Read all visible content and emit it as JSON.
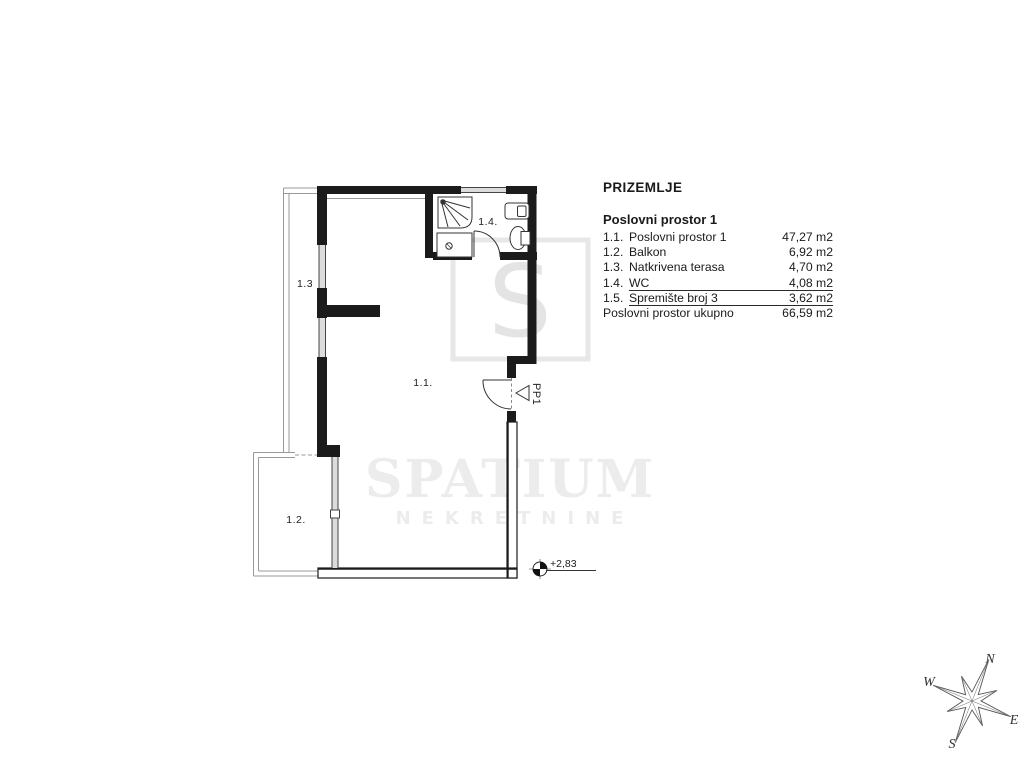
{
  "legend": {
    "heading": "PRIZEMLJE",
    "subheading": "Poslovni prostor 1",
    "rows": [
      {
        "num": "1.1.",
        "name": "Poslovni prostor 1",
        "area": "47,27 m2"
      },
      {
        "num": "1.2.",
        "name": "Balkon",
        "area": "6,92 m2"
      },
      {
        "num": "1.3.",
        "name": "Natkrivena terasa",
        "area": "4,70 m2"
      },
      {
        "num": "1.4.",
        "name": "WC",
        "area": "4,08 m2"
      },
      {
        "num": "1.5.",
        "name": "Spremište broj 3",
        "area": "3,62 m2"
      }
    ],
    "total": {
      "name": "Poslovni prostor ukupno",
      "area": "66,59 m2"
    }
  },
  "plan": {
    "room_labels": [
      {
        "id": "room-1-1",
        "text": "1.1."
      },
      {
        "id": "room-1-2",
        "text": "1.2."
      },
      {
        "id": "room-1-3",
        "text": "1.3"
      },
      {
        "id": "room-1-4",
        "text": "1.4."
      }
    ],
    "door_label": "PP1",
    "elevation_label": "+2,83"
  },
  "watermark": {
    "logo_letter": "S",
    "brand": "SPATIUM",
    "brand_sub": "NEKRETNINE"
  },
  "compass": {
    "n": "N",
    "e": "E",
    "s": "S",
    "w": "W"
  },
  "colors": {
    "line": "#1b1b1b",
    "thin_line": "#555555",
    "outline_gray": "#8a8a8a",
    "window_fill": "#dcdcdc",
    "watermark_gray": "#e9e9e9",
    "text": "#1a1a1a"
  }
}
